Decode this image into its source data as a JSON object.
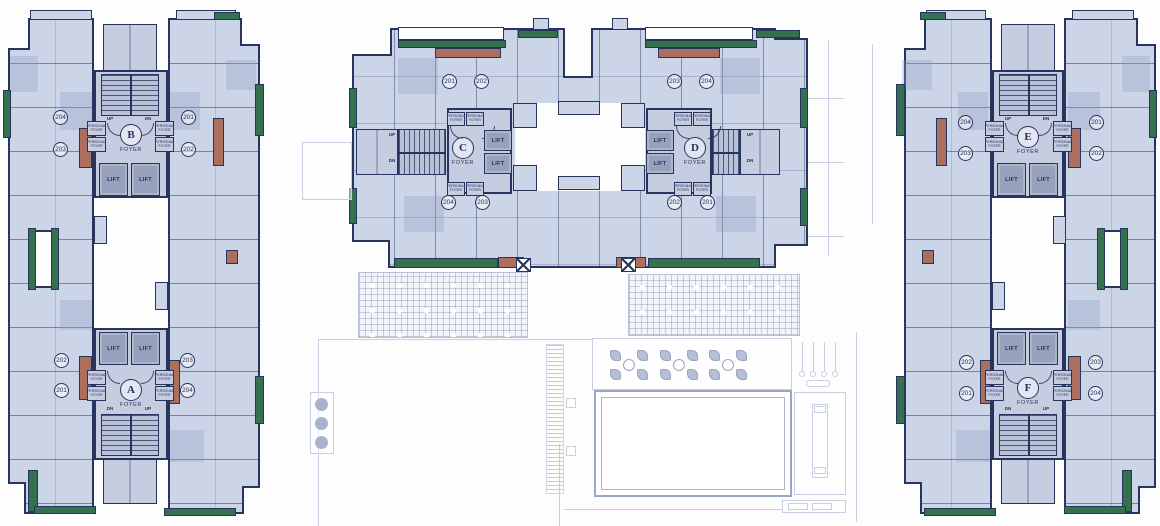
{
  "labels": {
    "lift": "LIFT",
    "foyer": "FOYER",
    "personal_foyer": "PERSONAL FOYER",
    "up": "UP",
    "dn": "DN"
  },
  "blocks": {
    "A": {
      "letter": "A",
      "units": [
        "202",
        "201",
        "203",
        "204"
      ]
    },
    "B": {
      "letter": "B",
      "units": [
        "204",
        "203",
        "201",
        "202"
      ]
    },
    "C": {
      "letter": "C",
      "units": [
        "201",
        "202",
        "204",
        "203"
      ]
    },
    "D": {
      "letter": "D",
      "units": [
        "203",
        "204",
        "202",
        "201"
      ]
    },
    "E": {
      "letter": "E",
      "units": [
        "204",
        "203",
        "201",
        "202"
      ]
    },
    "F": {
      "letter": "F",
      "units": [
        "202",
        "201",
        "203",
        "204"
      ]
    }
  },
  "colors": {
    "wall": "#26345e",
    "unit_fill": "#ccd4e7",
    "core_fill": "#c6cde0",
    "lift_fill": "#97a1bc",
    "green": "#35704f",
    "terracotta": "#ad6f5d",
    "faint_line": "#c9cfe2",
    "background": "#fdfdfe",
    "pool_edge": "#9aa6c6",
    "furniture": "#b7bfd6"
  }
}
